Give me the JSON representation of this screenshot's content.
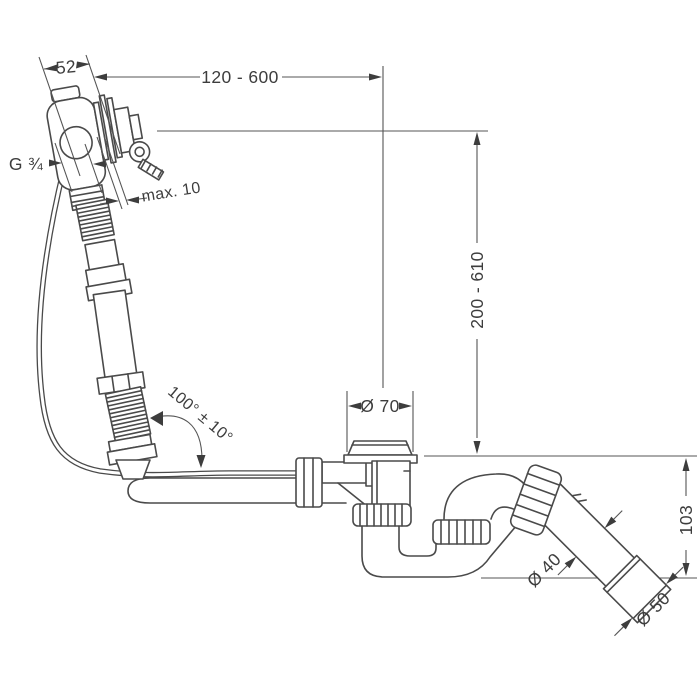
{
  "drawing": {
    "labels": {
      "width": "52",
      "reach": "120 - 600",
      "height": "200 - 610",
      "thread": "G ¾",
      "max_wall": "max. 10",
      "angle": "100° ± 10°",
      "drain_diameter": "Ø 70",
      "trap_height": "103",
      "pipe_diameter": "Ø 40",
      "outlet_diameter": "Ø 50"
    },
    "colors": {
      "line": "#4a4a4a",
      "dimension_text": "#3d3d3d",
      "background": "#ffffff"
    }
  }
}
